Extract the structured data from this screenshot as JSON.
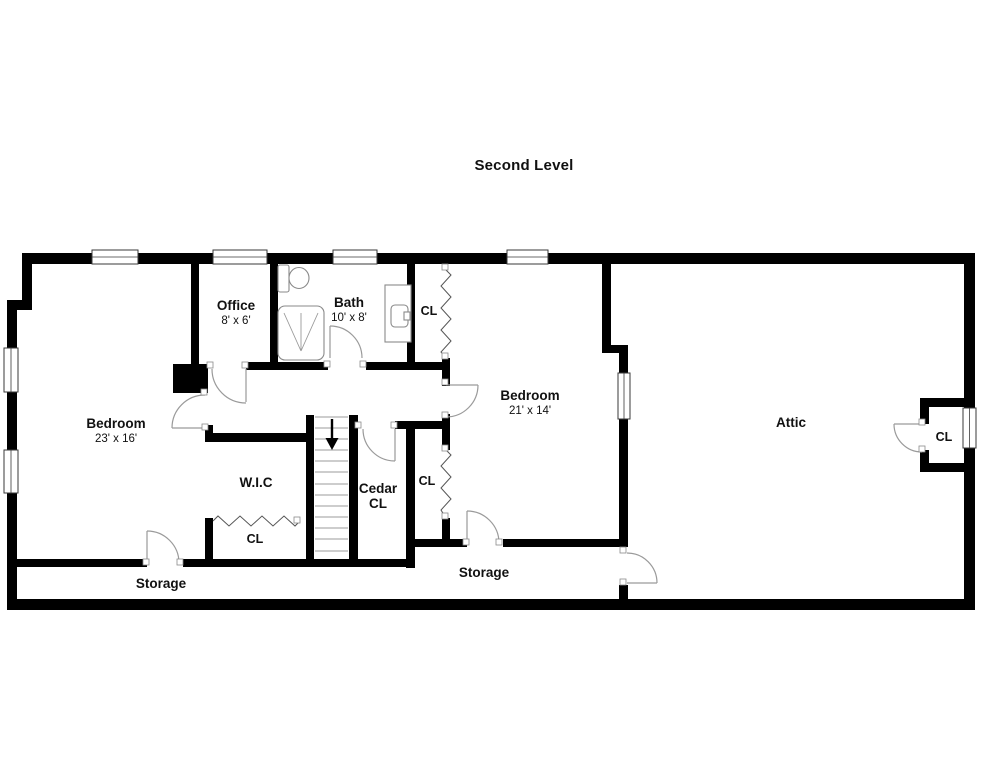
{
  "title": "Second Level",
  "rooms": {
    "office": {
      "name": "Office",
      "dims": "8' x 6'"
    },
    "bath": {
      "name": "Bath",
      "dims": "10' x 8'"
    },
    "bedroom_left": {
      "name": "Bedroom",
      "dims": "23' x 16'"
    },
    "bedroom_right": {
      "name": "Bedroom",
      "dims": "21' x 14'"
    },
    "attic": {
      "name": "Attic"
    },
    "wic": {
      "name": "W.I.C"
    },
    "cedar_closet": {
      "line1": "Cedar",
      "line2": "CL"
    },
    "closet_hall": {
      "name": "CL"
    },
    "closet_mid": {
      "name": "CL"
    },
    "closet_wic": {
      "name": "CL"
    },
    "closet_attic": {
      "name": "CL"
    },
    "storage_left": {
      "name": "Storage"
    },
    "storage_right": {
      "name": "Storage"
    }
  },
  "colors": {
    "wall": "#000000",
    "door_arc": "#9a9a9a",
    "fixture": "#8a8a8a",
    "stair_tread": "#9b9b9b",
    "zigzag": "#555555",
    "text": "#111111",
    "background": "#ffffff"
  }
}
